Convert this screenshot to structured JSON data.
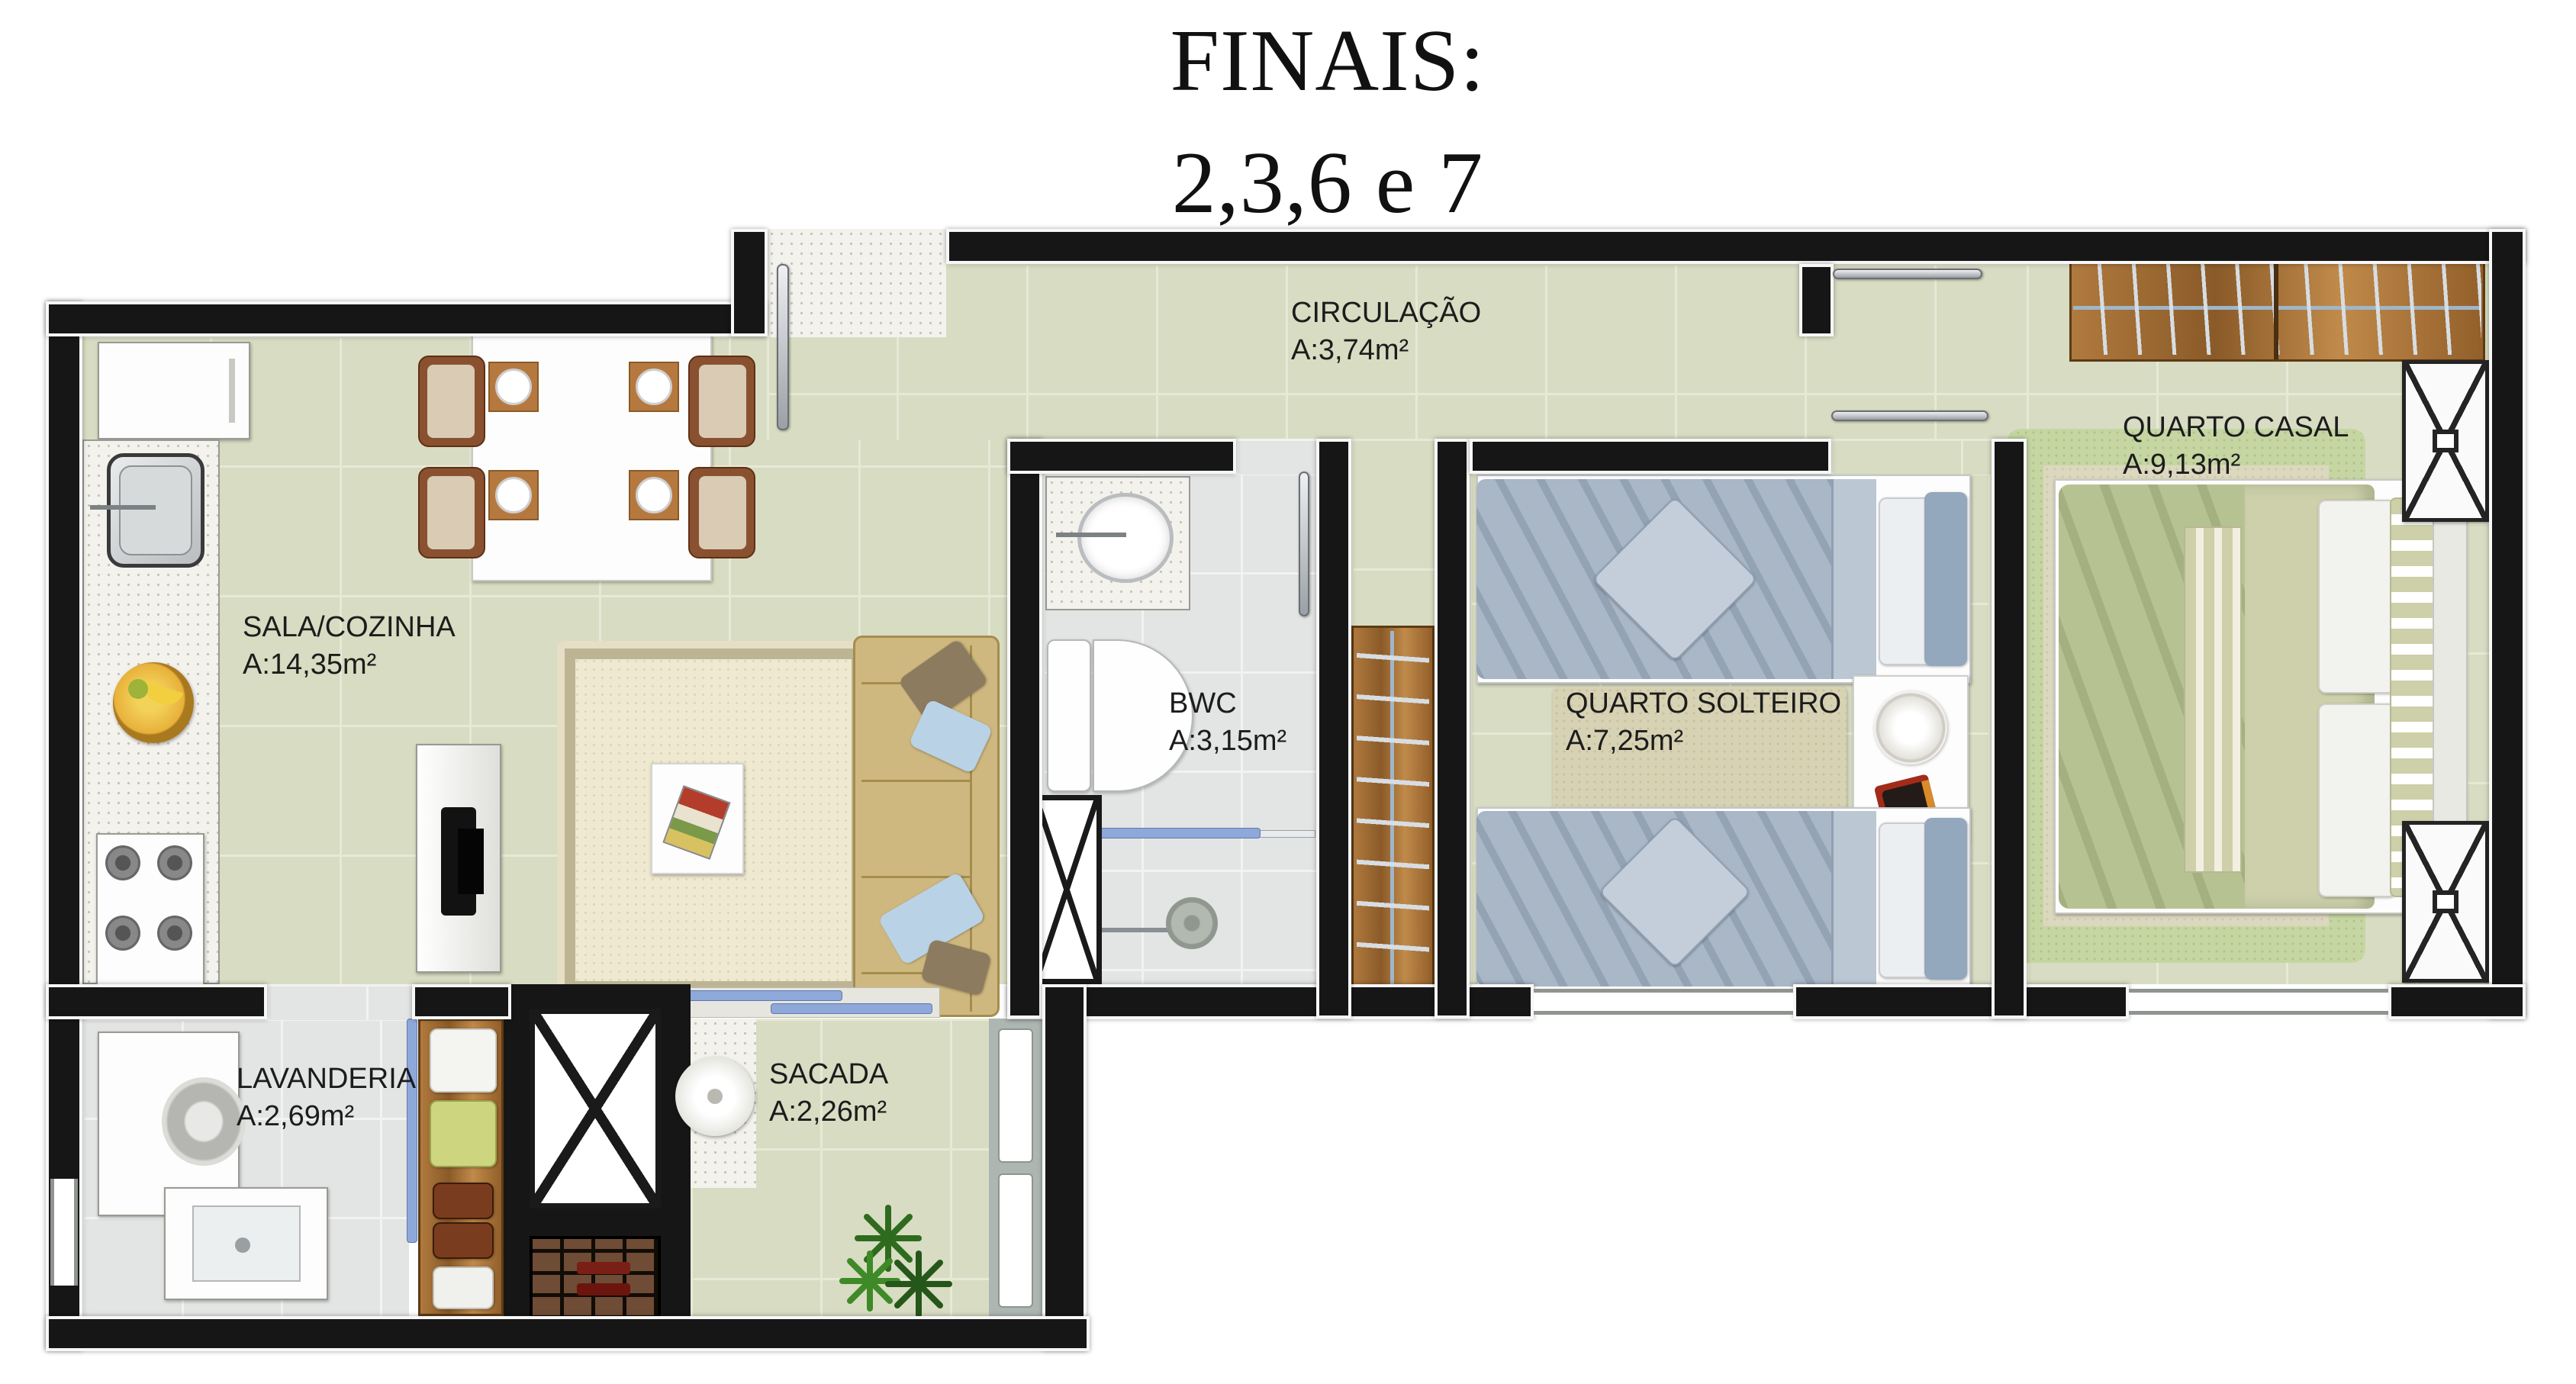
{
  "title": {
    "line1": "FINAIS:",
    "line2": "2,3,6 e 7"
  },
  "rooms": {
    "sala": {
      "name": "SALA/COZINHA",
      "area": "A:14,35m²"
    },
    "circulacao": {
      "name": "CIRCULAÇÃO",
      "area": "A:3,74m²"
    },
    "bwc": {
      "name": "BWC",
      "area": "A:3,15m²"
    },
    "solteiro": {
      "name": "QUARTO SOLTEIRO",
      "area": "A:7,25m²"
    },
    "casal": {
      "name": "QUARTO CASAL",
      "area": "A:9,13m²"
    },
    "lavanderia": {
      "name": "LAVANDERIA",
      "area": "A:2,69m²"
    },
    "sacada": {
      "name": "SACADA",
      "area": "A:2,26m²"
    }
  },
  "colors": {
    "wall": "#161616",
    "floor_sage": "#d8dcc2",
    "floor_gray": "#e2e5e3",
    "glass_blue": "#8fa8da",
    "sofa_tan": "#cfb87f",
    "duvet_blue": "#a9b7c6",
    "duvet_green": "#b7c293",
    "wood": "#a06a34"
  }
}
